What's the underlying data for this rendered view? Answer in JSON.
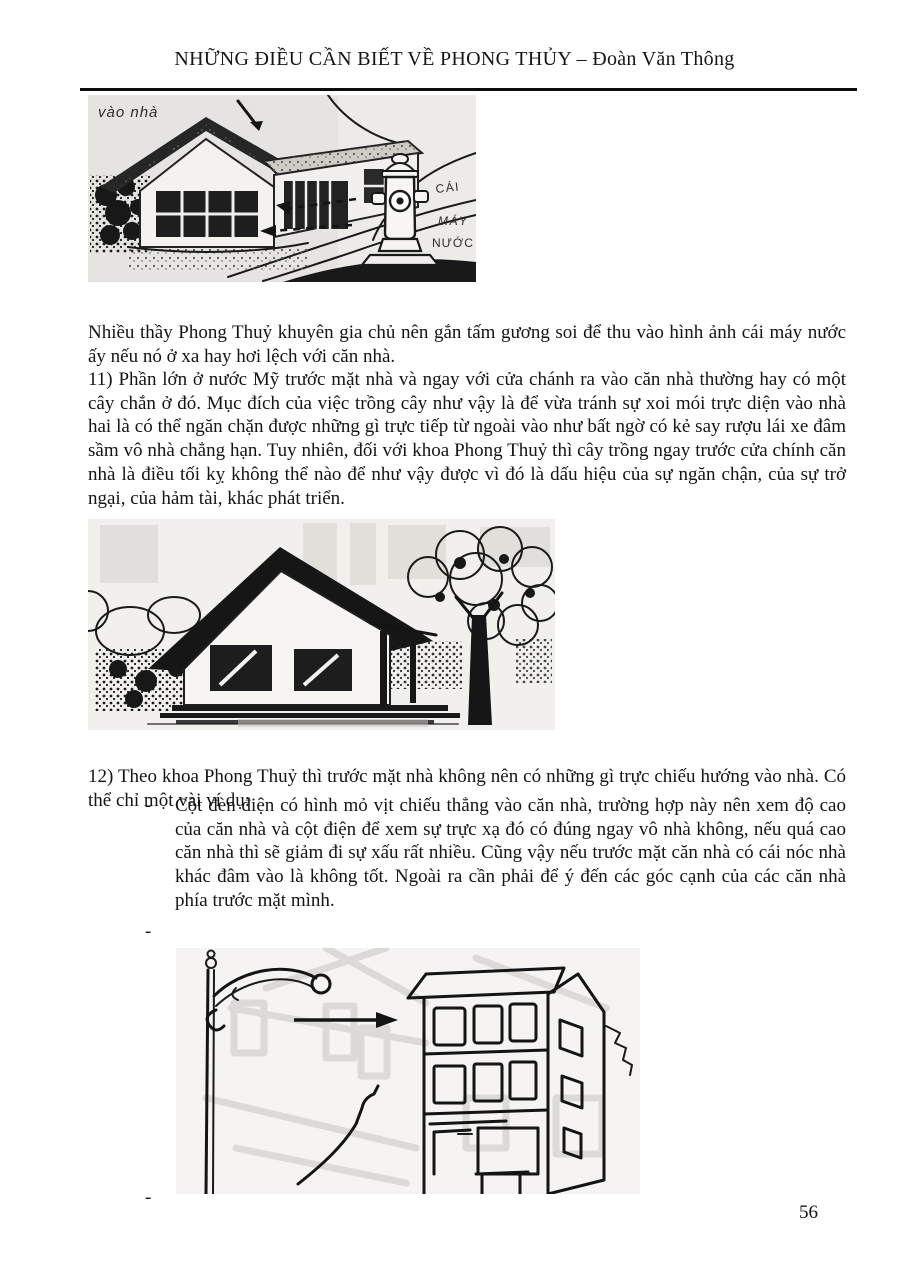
{
  "header": {
    "title": "NHỮNG ĐIỀU CẦN BIẾT VỀ PHONG THỦY – Đoàn Văn Thông"
  },
  "content": {
    "para_intro": "Nhiều thầy Phong Thuỷ khuyên gia chủ nên gắn tấm gương soi để thu vào hình ảnh cái máy nước ấy nếu nó ở xa hay hơi lệch với căn nhà.",
    "para_11": "11) Phần lớn ở nước Mỹ trước mặt nhà và ngay với cửa chánh ra vào căn nhà thường hay có một cây chắn ở đó. Mục đích của việc trồng cây như vậy là để vừa tránh sự xoi mói trực diện vào nhà hai là có thể ngăn chặn được những gì trực tiếp từ ngoài vào như bất ngờ có kẻ say rượu lái xe đâm sầm vô nhà chẳng hạn. Tuy nhiên, đối với khoa Phong Thuỷ thì cây trồng ngay trước cửa chính căn nhà là điều tối kỵ không thể nào để như vậy được vì đó là dấu hiệu của sự ngăn chận, của sự trở ngại, của hảm tài, khác phát triển.",
    "para_12": "12) Theo khoa Phong Thuỷ thì trước mặt nhà không nên có những gì trực chiếu hướng vào nhà. Có thể chỉ một vài ví dụ:",
    "bullet_marker": "-",
    "bullet_1": "Cột đèn điện có hình mỏ vịt chiếu thẳng vào căn nhà, trường hợp này nên xem độ cao của căn nhà và cột điện để xem sự trực xạ đó có đúng ngay vô nhà không, nếu quá cao căn nhà thì sẽ giảm đi sự xấu rất nhiều. Cũng vậy nếu trước mặt căn nhà có cái nóc nhà khác đâm vào là không tốt. Ngoài ra cần phải để ý đến các góc cạnh của các căn nhà phía trước mặt mình.",
    "dash": "-"
  },
  "figures": {
    "hydrant_scene": {
      "label_vao_nha": "vào nhà",
      "label_cai": "CÁI",
      "label_may": "MÁY",
      "label_nuoc": "NƯỚC"
    }
  },
  "footer": {
    "page_number": "56"
  },
  "colors": {
    "ink": "#141414",
    "scan_bg": "#e6e4e0"
  }
}
